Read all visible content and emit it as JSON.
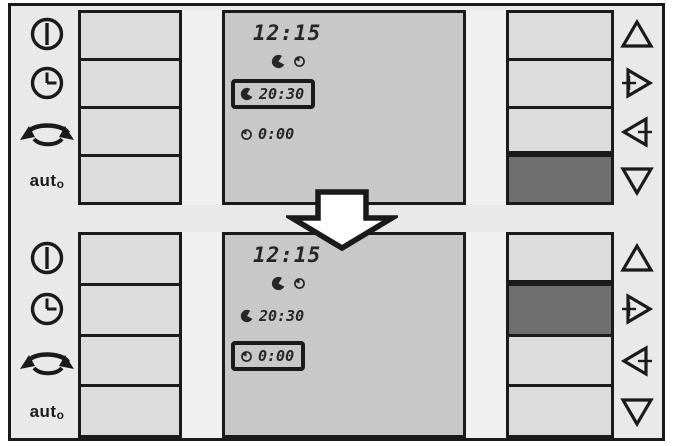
{
  "colors": {
    "frame_bg": "#e9e9e9",
    "cell_bg": "#dcdcdc",
    "display_bg": "#c8c8c8",
    "pressed_bg": "#6f6f6f",
    "strip_bg": "#f0f0f0",
    "ink": "#1a1a1a",
    "digit_ink": "#262626",
    "arrow_fill": "#ffffff"
  },
  "left_controls": {
    "icons": [
      "power-icon",
      "clock-icon",
      "changeover-arrows-icon",
      "auto-label"
    ],
    "auto_main": "aut",
    "auto_sub": "o"
  },
  "right_controls": {
    "icons": [
      "triangle-up-icon",
      "triangle-right-plus-icon",
      "triangle-left-minus-icon",
      "triangle-down-icon"
    ]
  },
  "display_legend_icons": [
    "on-time-icon",
    "off-time-icon"
  ],
  "transition": {
    "type": "down-block-arrow"
  },
  "panels": [
    {
      "name": "state-before",
      "display": {
        "time": "12:15",
        "rows": [
          {
            "icon": "on-time-icon",
            "value": "20:30",
            "selected": true
          },
          {
            "icon": "off-time-icon",
            "value": "0:00",
            "selected": false
          }
        ]
      },
      "left_buttons_pressed": [
        false,
        false,
        false,
        false
      ],
      "right_buttons_pressed": [
        false,
        false,
        false,
        true
      ]
    },
    {
      "name": "state-after",
      "display": {
        "time": "12:15",
        "rows": [
          {
            "icon": "on-time-icon",
            "value": "20:30",
            "selected": false
          },
          {
            "icon": "off-time-icon",
            "value": "0:00",
            "selected": true
          }
        ]
      },
      "left_buttons_pressed": [
        false,
        false,
        false,
        false
      ],
      "right_buttons_pressed": [
        false,
        true,
        false,
        false
      ]
    }
  ]
}
